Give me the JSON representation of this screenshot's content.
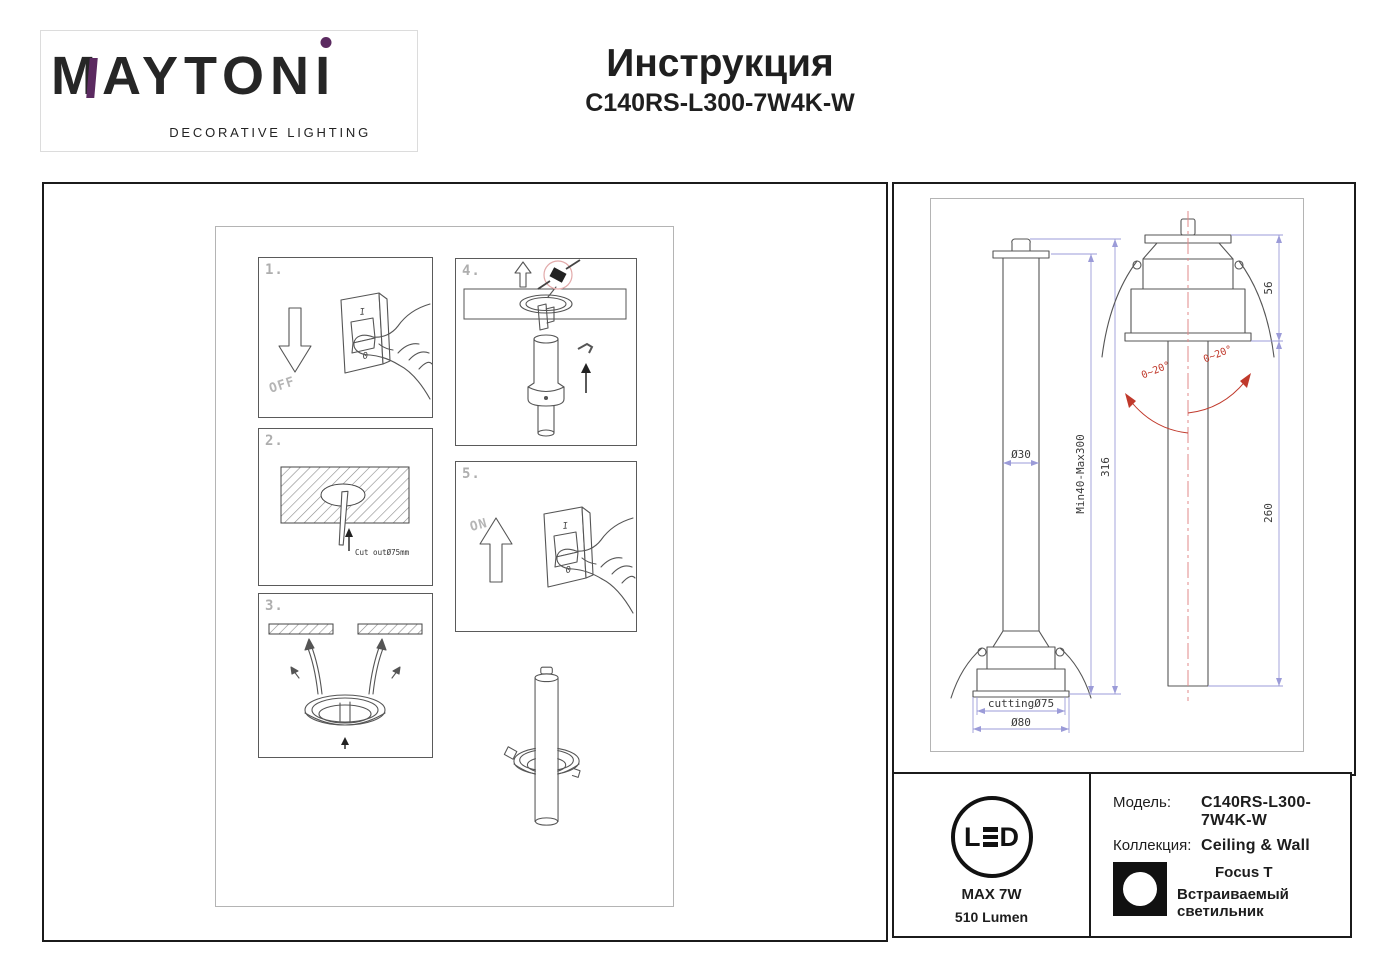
{
  "header": {
    "brand": "MAYTONI",
    "brand_main": "MAYTON",
    "brand_i": "I",
    "tagline": "DECORATIVE LIGHTING",
    "title": "Инструкция",
    "model": "C140RS-L300-7W4K-W"
  },
  "steps": {
    "s1": {
      "num": "1.",
      "action": "OFF",
      "sw_top": "I",
      "sw_bottom": "0"
    },
    "s2": {
      "num": "2.",
      "note": "Cut outØ75mm"
    },
    "s3": {
      "num": "3."
    },
    "s4": {
      "num": "4."
    },
    "s5": {
      "num": "5.",
      "action": "ON",
      "sw_top": "I",
      "sw_bottom": "0"
    }
  },
  "dimensions": {
    "tube_diameter": "Ø30",
    "height_range": "Min40-Max300",
    "total_height": "316",
    "cutting_hole": "cuttingØ75",
    "flange_diameter": "Ø80",
    "housing_height": "56",
    "tube_length": "260",
    "tilt_left": "0~20°",
    "tilt_right": "0~20°"
  },
  "info": {
    "led_l": "L",
    "led_d": "D",
    "max_power": "MAX 7W",
    "luminous_flux": "510 Lumen",
    "model_label": "Модель:",
    "model_value": "C140RS-L300-7W4K-W",
    "collection_label": "Коллекция:",
    "collection_value": "Ceiling & Wall",
    "series": "Focus T",
    "fixture_type": "Встраиваемый светильник"
  },
  "colors": {
    "brand_purple": "#5b2a60",
    "dimension_blue": "#9b9bd8",
    "cad_red": "#c0392b",
    "sketch_gray": "#555555"
  }
}
